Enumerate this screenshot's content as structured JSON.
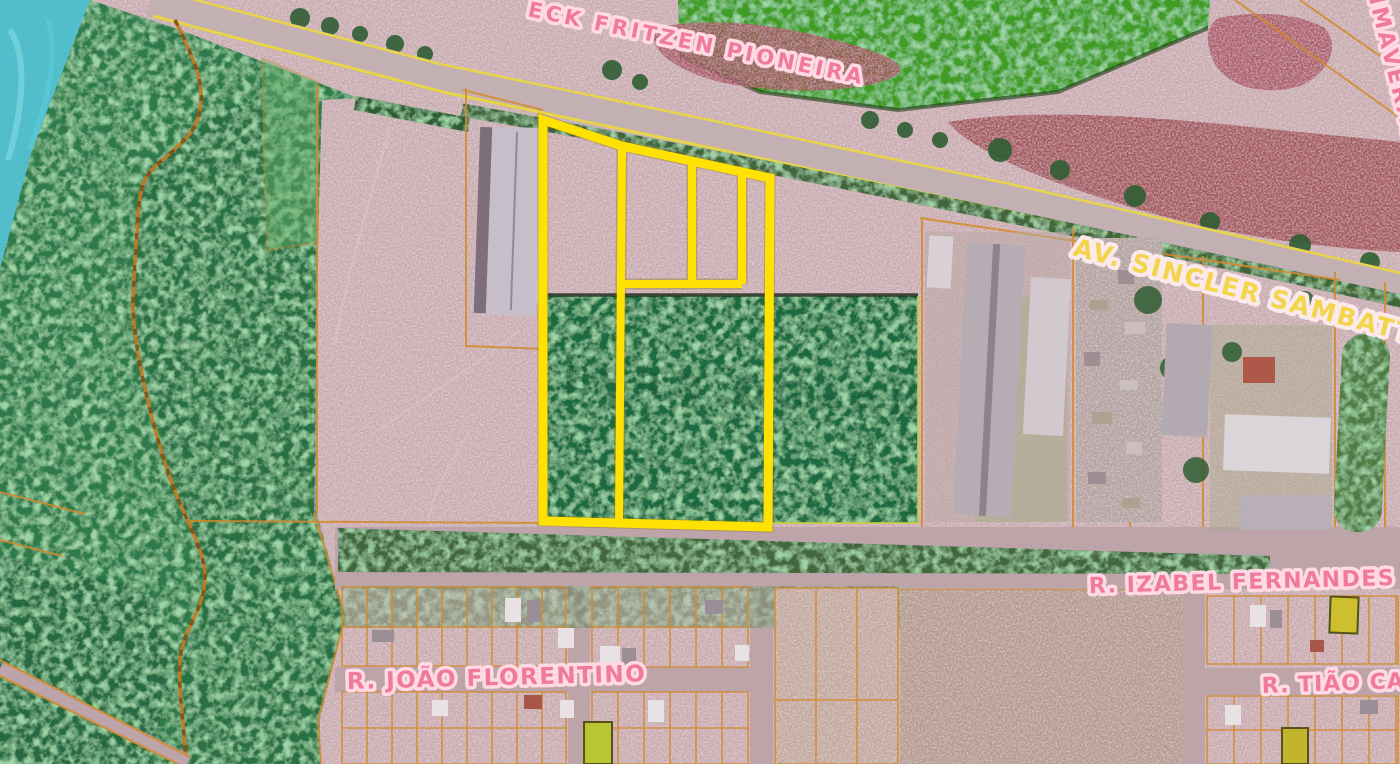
{
  "map": {
    "selected_parcel": {
      "outline_color": "#ffe103"
    },
    "streets": {
      "fritzen": {
        "text": "ECK FRITZEN PIONEIRA",
        "color": "#ef7a9c"
      },
      "sambatti": {
        "text": "AV. SINCLER SAMBATTI PREFE",
        "color": "#f2d54b"
      },
      "primaveras": {
        "text": "IMAVERAS DO",
        "color": "#ef7a9c"
      },
      "izabel": {
        "text": "R. IZABEL FERNANDES CANC",
        "color": "#ef7a9c"
      },
      "joao": {
        "text": "R. JOÃO FLORENTINO",
        "color": "#ef7a9c"
      },
      "tiao": {
        "text": "R. TIÃO CAR",
        "color": "#ef7a9c"
      }
    },
    "watermark": {
      "text": "EBRO OGRAN"
    },
    "layers": {
      "water_overlay": "#2fc0cf",
      "vegetation_overlay": "#2e7a4c",
      "dense_wood": "#1e6b42",
      "forest": "#3f9c22",
      "exposed_red_soil": "#a5485a",
      "bare_soil": "#c9abb1",
      "cadastral_line": "#d4892a",
      "road_edge_line": "#e8d44a",
      "label_halo": "#ffd9e4"
    }
  }
}
